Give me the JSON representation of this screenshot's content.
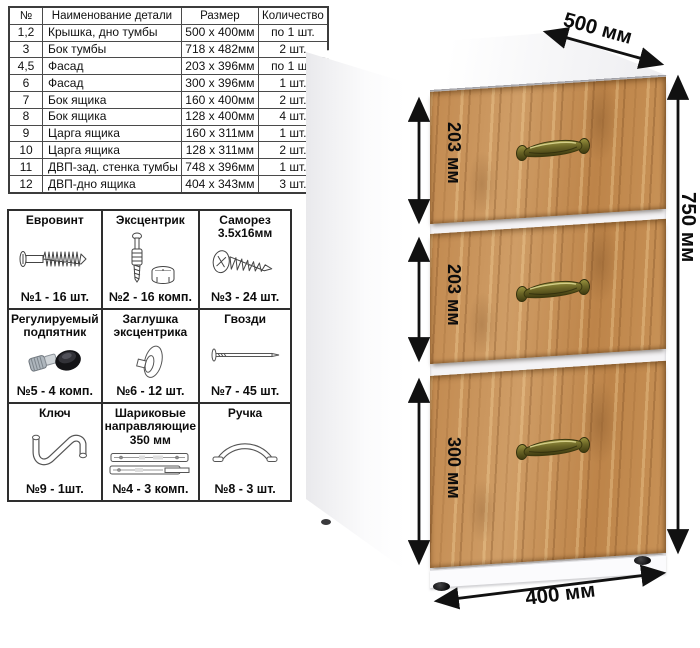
{
  "parts_table": {
    "headers": [
      "№",
      "Наименование детали",
      "Размер",
      "Количество"
    ],
    "rows": [
      [
        "1,2",
        "Крышка, дно тумбы",
        "500 х 400мм",
        "по 1 шт."
      ],
      [
        "3",
        "Бок тумбы",
        "718 х 482мм",
        "2 шт."
      ],
      [
        "4,5",
        "Фасад",
        "203 х 396мм",
        "по 1 шт."
      ],
      [
        "6",
        "Фасад",
        "300 х 396мм",
        "1 шт."
      ],
      [
        "7",
        "Бок ящика",
        "160 х 400мм",
        "2 шт."
      ],
      [
        "8",
        "Бок ящика",
        "128 х 400мм",
        "4 шт."
      ],
      [
        "9",
        "Царга ящика",
        "160 х 311мм",
        "1 шт."
      ],
      [
        "10",
        "Царга ящика",
        "128 х 311мм",
        "2 шт."
      ],
      [
        "11",
        "ДВП-зад. стенка тумбы",
        "748 х 396мм",
        "1 шт."
      ],
      [
        "12",
        "ДВП-дно ящика",
        "404 х 343мм",
        "3 шт."
      ]
    ]
  },
  "hardware": {
    "items": [
      {
        "title": "Евровинт",
        "count": "№1 - 16 шт.",
        "icon": "euro-screw-icon"
      },
      {
        "title": "Эксцентрик",
        "count": "№2 - 16 комп.",
        "icon": "cam-lock-icon"
      },
      {
        "title": "Саморез 3.5х16мм",
        "count": "№3 - 24 шт.",
        "icon": "self-tapping-screw-icon"
      },
      {
        "title": "Регулируемый подпятник",
        "count": "№5 - 4 комп.",
        "icon": "adjustable-foot-icon"
      },
      {
        "title": "Заглушка эксцентрика",
        "count": "№6 - 12 шт.",
        "icon": "cam-cap-icon"
      },
      {
        "title": "Гвозди",
        "count": "№7 - 45 шт.",
        "icon": "nail-icon"
      },
      {
        "title": "Ключ",
        "count": "№9 - 1шт.",
        "icon": "hex-key-icon"
      },
      {
        "title": "Шариковые направляющие 350 мм",
        "count": "№4 - 3 комп.",
        "icon": "ball-slides-icon"
      },
      {
        "title": "Ручка",
        "count": "№8 - 3 шт.",
        "icon": "handle-icon"
      }
    ]
  },
  "dimensions": {
    "depth": "500 мм",
    "height": "750 мм",
    "width": "400 мм",
    "drawer1": "203 мм",
    "drawer2": "203 мм",
    "drawer3": "300 мм"
  },
  "colors": {
    "wood": "#c28a50",
    "handle_bronze": "#6b6526",
    "dimension_lines": "#111111",
    "table_border": "#2e2e2e",
    "carcass_white": "#fbfbfd"
  }
}
